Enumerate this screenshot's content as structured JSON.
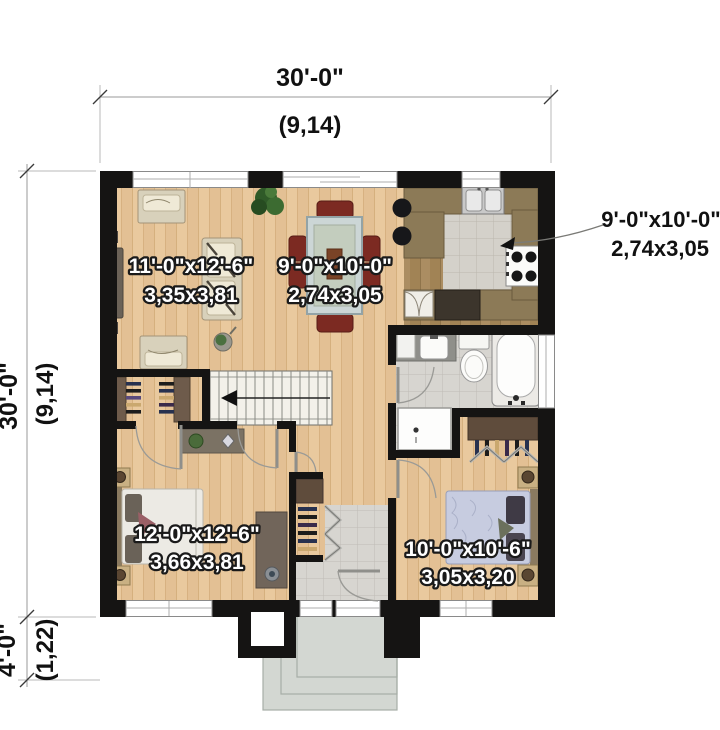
{
  "plan_title": "single storey house floor plan",
  "colors": {
    "wall": "#151413",
    "wood_floor": "#e9c99e",
    "kitchen_floor": "#b2946a",
    "tile_floor": "#d7d5d0",
    "porch_concrete": "#d3d7d2",
    "counter": "#8c7a57",
    "closet_panel": "#6e5b4b",
    "label_fill": "#ffffff",
    "label_outline": "#1a1a1a",
    "dim_text": "#111111"
  },
  "dimensions": {
    "width_top": {
      "imperial": "30'-0\"",
      "metric": "(9,14)"
    },
    "depth_left": {
      "imperial": "30'-0\"",
      "metric": "(9,14)"
    },
    "porch_depth": {
      "imperial": "4'-0\"",
      "metric": "(1,22)"
    }
  },
  "rooms": {
    "living": {
      "imperial": "11'-0\"x12'-6\"",
      "metric": "3,35x3,81"
    },
    "dining": {
      "imperial": "9'-0\"x10'-0\"",
      "metric": "2,74x3,05"
    },
    "kitchen": {
      "imperial": "9'-0\"x10'-0\"",
      "metric": "2,74x3,05"
    },
    "master_bedroom": {
      "imperial": "12'-0\"x12'-6\"",
      "metric": "3,66x3,81"
    },
    "bedroom2": {
      "imperial": "10'-0\"x10'-6\"",
      "metric": "3,05x3,20"
    }
  }
}
